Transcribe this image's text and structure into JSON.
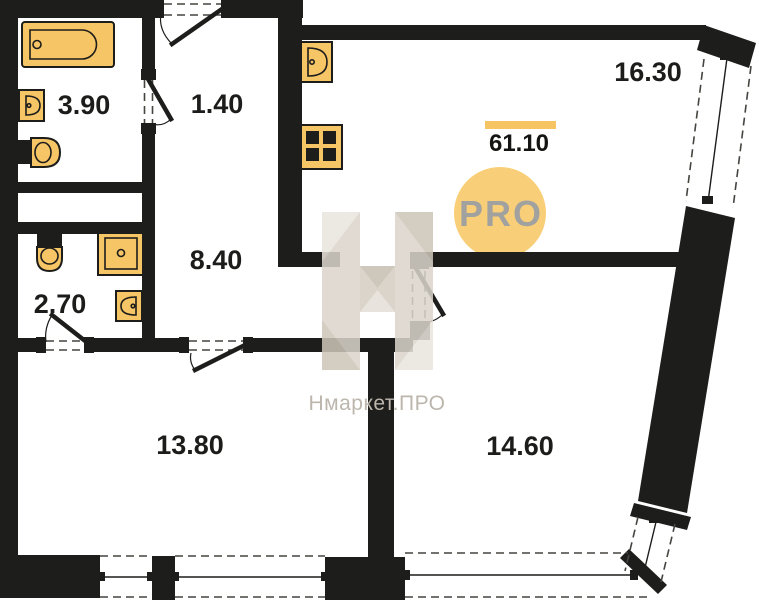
{
  "plan": {
    "total_area": "61.10",
    "badge_text": "PRO",
    "watermark_text": "Нмаркет.ПРО",
    "rooms": [
      {
        "id": "bathroom",
        "area": "3.90"
      },
      {
        "id": "entry-nook",
        "area": "1.40"
      },
      {
        "id": "kitchen-living",
        "area": "16.30"
      },
      {
        "id": "corridor",
        "area": "8.40"
      },
      {
        "id": "toilet",
        "area": "2.70"
      },
      {
        "id": "room-left",
        "area": "13.80"
      },
      {
        "id": "room-right",
        "area": "14.60"
      }
    ],
    "colors": {
      "wall": "#1d1d1b",
      "fixture": "#f6c565",
      "accent_bar": "#f6c462",
      "badge": "#f8cf78",
      "badge_text": "#a1a19f",
      "watermark": "#dbd5cb"
    }
  }
}
